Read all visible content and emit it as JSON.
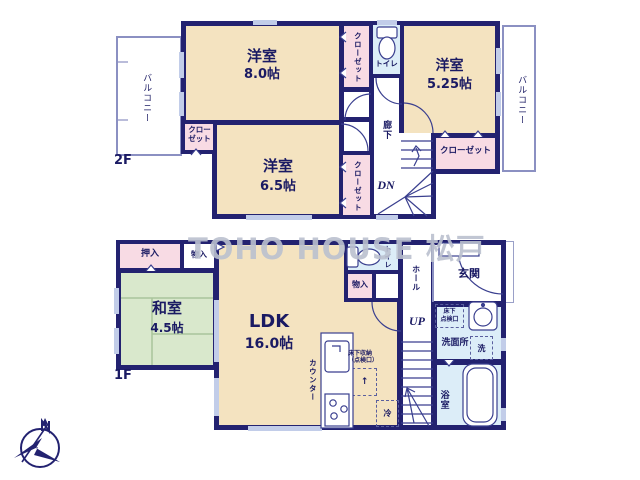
{
  "watermark": "TOHO HOUSE 松戸",
  "colors": {
    "wall": "#232270",
    "room_cream": "#f4e3c0",
    "closet_pink": "#f8dbe4",
    "wet_blue": "#dcedf8",
    "tatami_green": "#d9e8cc",
    "window": "#c2cde9",
    "watermark": "#bac0ce"
  },
  "floor2": {
    "label": "2F",
    "balcony_left": "バルコニー",
    "balcony_right": "バルコニー",
    "room_8": {
      "name": "洋室",
      "size": "8.0帖"
    },
    "room_525": {
      "name": "洋室",
      "size": "5.25帖"
    },
    "room_65": {
      "name": "洋室",
      "size": "6.5帖"
    },
    "closet_8": "クローゼット",
    "closet_525": "クローゼット",
    "closet_65_left": {
      "line1": "クロー",
      "line2": "ゼット"
    },
    "closet_65_right": "クローゼット",
    "toilet": "トイレ",
    "hallway": "廊下",
    "stairs_down": "DN"
  },
  "floor1": {
    "label": "1F",
    "oshiire": "押入",
    "storage_top": "物入",
    "washitsu": {
      "name": "和室",
      "size": "4.5帖"
    },
    "ldk": {
      "name": "LDK",
      "size": "16.0帖"
    },
    "toilet": "トイレ",
    "storage_mid": "物入",
    "hall": "ホール",
    "genkan": "玄関",
    "stairs_up": "UP",
    "washroom": "洗面所",
    "washer": "洗",
    "bathroom": "浴室",
    "counter": "カウンター",
    "underfloor_storage": {
      "line1": "床下収納",
      "line2": "（点検口）"
    },
    "underfloor_hatch": {
      "line1": "床下",
      "line2": "点検口"
    },
    "fridge": "冷"
  },
  "compass": {
    "north": "N"
  }
}
